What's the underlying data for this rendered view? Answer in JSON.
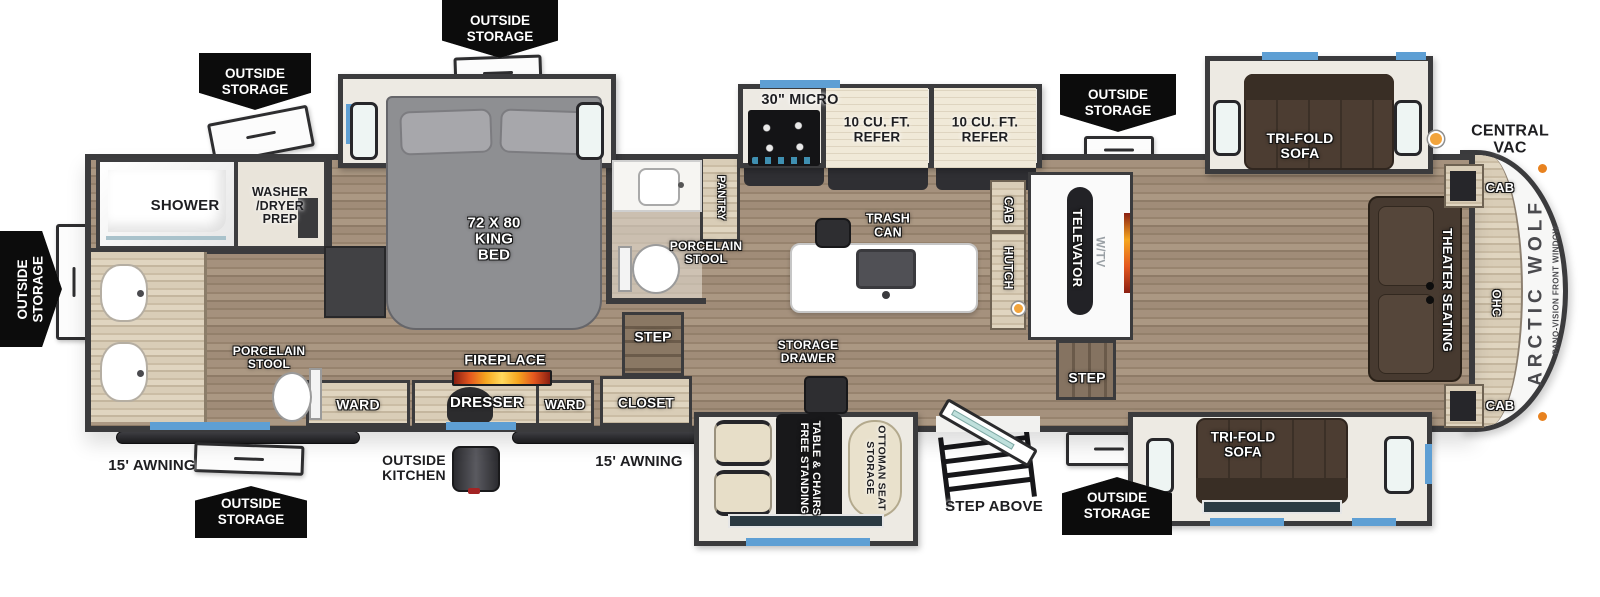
{
  "branding": {
    "model": "ARCTIC WOLF",
    "front_window_note": "PANO-VISION FRONT WINDOW"
  },
  "legend": {
    "central_vac_label": "CENTRAL VAC",
    "marker_color": "#F2A43C"
  },
  "colors": {
    "wall": "#3B3B3D",
    "accent_window": "#5E9FD4",
    "floor_wood": "#9D8A76",
    "badge_bg": "#0C0C0C"
  },
  "labels": {
    "outside_storage": "OUTSIDE\nSTORAGE",
    "shower": "SHOWER",
    "washer_dryer_prep": "WASHER\n/DRYER\nPREP",
    "king_bed": "72 X 80\nKING\nBED",
    "pantry": "PANTRY",
    "micro": "30\" MICRO",
    "refer": "10 CU. FT.\nREFER",
    "porcelain_stool": "PORCELAIN\nSTOOL",
    "trash_can": "TRASH\nCAN",
    "cab": "CAB",
    "hutch": "HUTCH",
    "televator": "TELEVATOR",
    "tv": "W/TV",
    "theater_seating": "THEATER SEATING",
    "ohc": "OHC",
    "tri_fold_sofa": "TRI-FOLD\nSOFA",
    "ward": "WARD",
    "dresser": "DRESSER",
    "fireplace": "FIREPLACE",
    "closet": "CLOSET",
    "step": "STEP",
    "step_above": "STEP ABOVE",
    "storage_drawer": "STORAGE\nDRAWER",
    "free_standing_table": "FREE STANDING\nTABLE & CHAIRS",
    "storage_ottoman": "STORAGE\nOTTOMAN SEAT",
    "outside_kitchen": "OUTSIDE\nKITCHEN",
    "awning_15": "15' AWNING"
  }
}
